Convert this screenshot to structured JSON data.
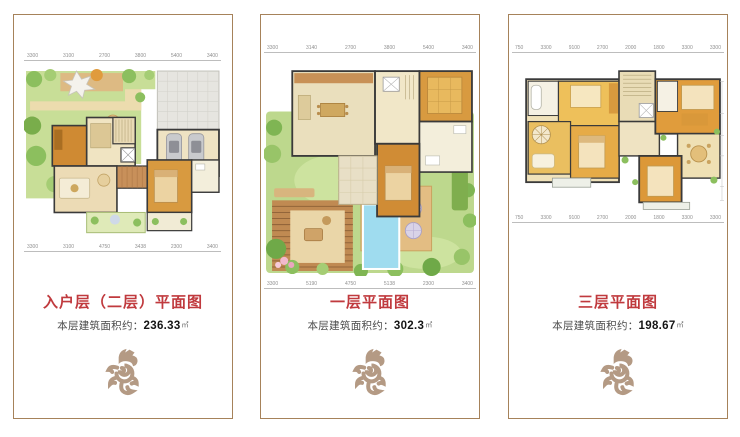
{
  "colors": {
    "title_red": "#c03a3e",
    "border_brown": "#a6825a",
    "dragon_tan": "#b49a84",
    "garden_green": "#bdd88d",
    "pool_blue": "#9fdcef",
    "wood_orange": "#d08c35"
  },
  "panels": [
    {
      "floor_id": "entry-second-floor",
      "title": "入户层（二层）平面图",
      "area_label": "本层建筑面积约：",
      "area_value": "236.33",
      "area_unit": "㎡",
      "dims_top": [
        "3300",
        "3100",
        "2700",
        "3800",
        "5400",
        "3400"
      ],
      "dims_bottom": [
        "3300",
        "3100",
        "4750",
        "3438",
        "2300",
        "3400"
      ]
    },
    {
      "floor_id": "first-floor",
      "title": "一层平面图",
      "area_label": "本层建筑面积约：",
      "area_value": "302.3",
      "area_unit": "㎡",
      "dims_top": [
        "3300",
        "3140",
        "2700",
        "3800",
        "5400",
        "3400"
      ],
      "dims_bottom": [
        "3300",
        "5190",
        "4750",
        "5138",
        "2300",
        "3400"
      ]
    },
    {
      "floor_id": "third-floor",
      "title": "三层平面图",
      "area_label": "本层建筑面积约：",
      "area_value": "198.67",
      "area_unit": "㎡",
      "dims_top": [
        "750",
        "3300",
        "9100",
        "2700",
        "2000",
        "1800",
        "3300",
        "3300"
      ],
      "dims_bottom": [
        "750",
        "3300",
        "9100",
        "2700",
        "2000",
        "1800",
        "3300",
        "3300"
      ]
    }
  ]
}
